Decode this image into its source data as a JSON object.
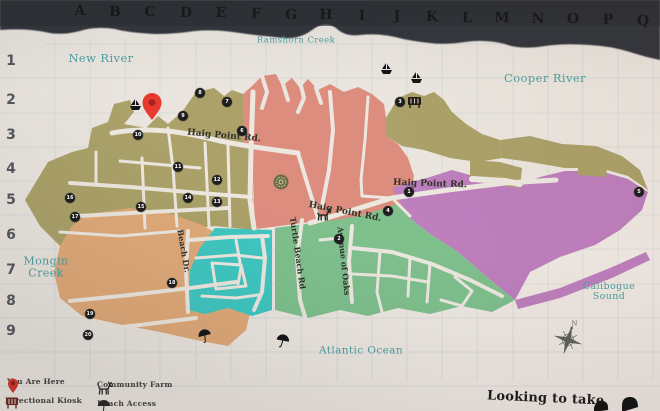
{
  "grid": {
    "columns": [
      "A",
      "B",
      "C",
      "D",
      "E",
      "F",
      "G",
      "H",
      "I",
      "J",
      "K",
      "L",
      "M",
      "N",
      "O",
      "P",
      "Q"
    ],
    "rows": [
      "1",
      "2",
      "3",
      "4",
      "5",
      "6",
      "7",
      "8",
      "9"
    ]
  },
  "water_labels": [
    {
      "text": "Ramshorn Creek",
      "x": 296,
      "y": 41,
      "size": 8.5
    },
    {
      "text": "New River",
      "x": 101,
      "y": 58,
      "size": 11.5
    },
    {
      "text": "Cooper River",
      "x": 545,
      "y": 78,
      "size": 11.5
    },
    {
      "text": "Mongin\nCreek",
      "x": 46,
      "y": 267,
      "size": 11
    },
    {
      "text": "Calibogue Sound",
      "x": 609,
      "y": 292,
      "size": 9.5
    },
    {
      "text": "Atlantic Ocean",
      "x": 361,
      "y": 351,
      "size": 10.5
    }
  ],
  "road_labels": [
    {
      "text": "Haig Point Rd.",
      "x": 224,
      "y": 136,
      "rot": 5,
      "size": 9
    },
    {
      "text": "Haig Point Rd.",
      "x": 345,
      "y": 212,
      "rot": 11,
      "size": 9
    },
    {
      "text": "Haig Point Rd.",
      "x": 430,
      "y": 184,
      "rot": 2,
      "size": 9
    },
    {
      "text": "Beach Dr.",
      "x": 184,
      "y": 251,
      "rot": 80,
      "size": 8
    },
    {
      "text": "Turtle Beach Rd",
      "x": 298,
      "y": 253,
      "rot": 82,
      "size": 8
    },
    {
      "text": "Avenue of Oaks",
      "x": 344,
      "y": 261,
      "rot": 84,
      "size": 8
    }
  ],
  "markers": [
    {
      "label": "8",
      "x": 200,
      "y": 93
    },
    {
      "label": "7",
      "x": 227,
      "y": 102
    },
    {
      "label": "9",
      "x": 183,
      "y": 116
    },
    {
      "label": "6",
      "x": 242,
      "y": 131
    },
    {
      "label": "10",
      "x": 138,
      "y": 135
    },
    {
      "label": "3",
      "x": 400,
      "y": 102
    },
    {
      "label": "1",
      "x": 409,
      "y": 192
    },
    {
      "label": "4",
      "x": 388,
      "y": 211
    },
    {
      "label": "5",
      "x": 639,
      "y": 192
    },
    {
      "label": "2",
      "x": 339,
      "y": 239
    },
    {
      "label": "11",
      "x": 178,
      "y": 167
    },
    {
      "label": "12",
      "x": 217,
      "y": 180
    },
    {
      "label": "14",
      "x": 188,
      "y": 198
    },
    {
      "label": "13",
      "x": 217,
      "y": 202
    },
    {
      "label": "15",
      "x": 141,
      "y": 207
    },
    {
      "label": "16",
      "x": 70,
      "y": 198
    },
    {
      "label": "17",
      "x": 75,
      "y": 217
    },
    {
      "label": "18",
      "x": 172,
      "y": 283
    },
    {
      "label": "19",
      "x": 90,
      "y": 314
    },
    {
      "label": "20",
      "x": 88,
      "y": 335
    }
  ],
  "poi_icons": [
    "ferry-icon",
    "ferry-icon",
    "ferry-icon",
    "kiosk-icon",
    "deer-icon",
    "umbrella-icon",
    "umbrella-icon",
    "tree-stamp-icon",
    "you-are-here-pin-icon",
    "compass-rose-icon"
  ],
  "legend": {
    "items": [
      {
        "icon": "location-pin-icon",
        "label": "You Are Here"
      },
      {
        "icon": "directional-kiosk-icon",
        "label": "Directional Kiosk"
      },
      {
        "icon": "community-farm-icon",
        "label": "Community Farm"
      },
      {
        "icon": "beach-access-icon",
        "label": "Beach Access"
      }
    ]
  },
  "footer": {
    "cta": "Looking to take"
  },
  "colors": {
    "olive": "#aba169",
    "salmon": "#dd8d7e",
    "teal_region": "#40c7c1",
    "green_region": "#7fc08d",
    "purple": "#bd7fbd",
    "orange": "#e0aa79",
    "water_text": "#4f9fa0",
    "road": "#ece7df",
    "header_band": "#33373d",
    "pin_red": "#e8392e"
  }
}
